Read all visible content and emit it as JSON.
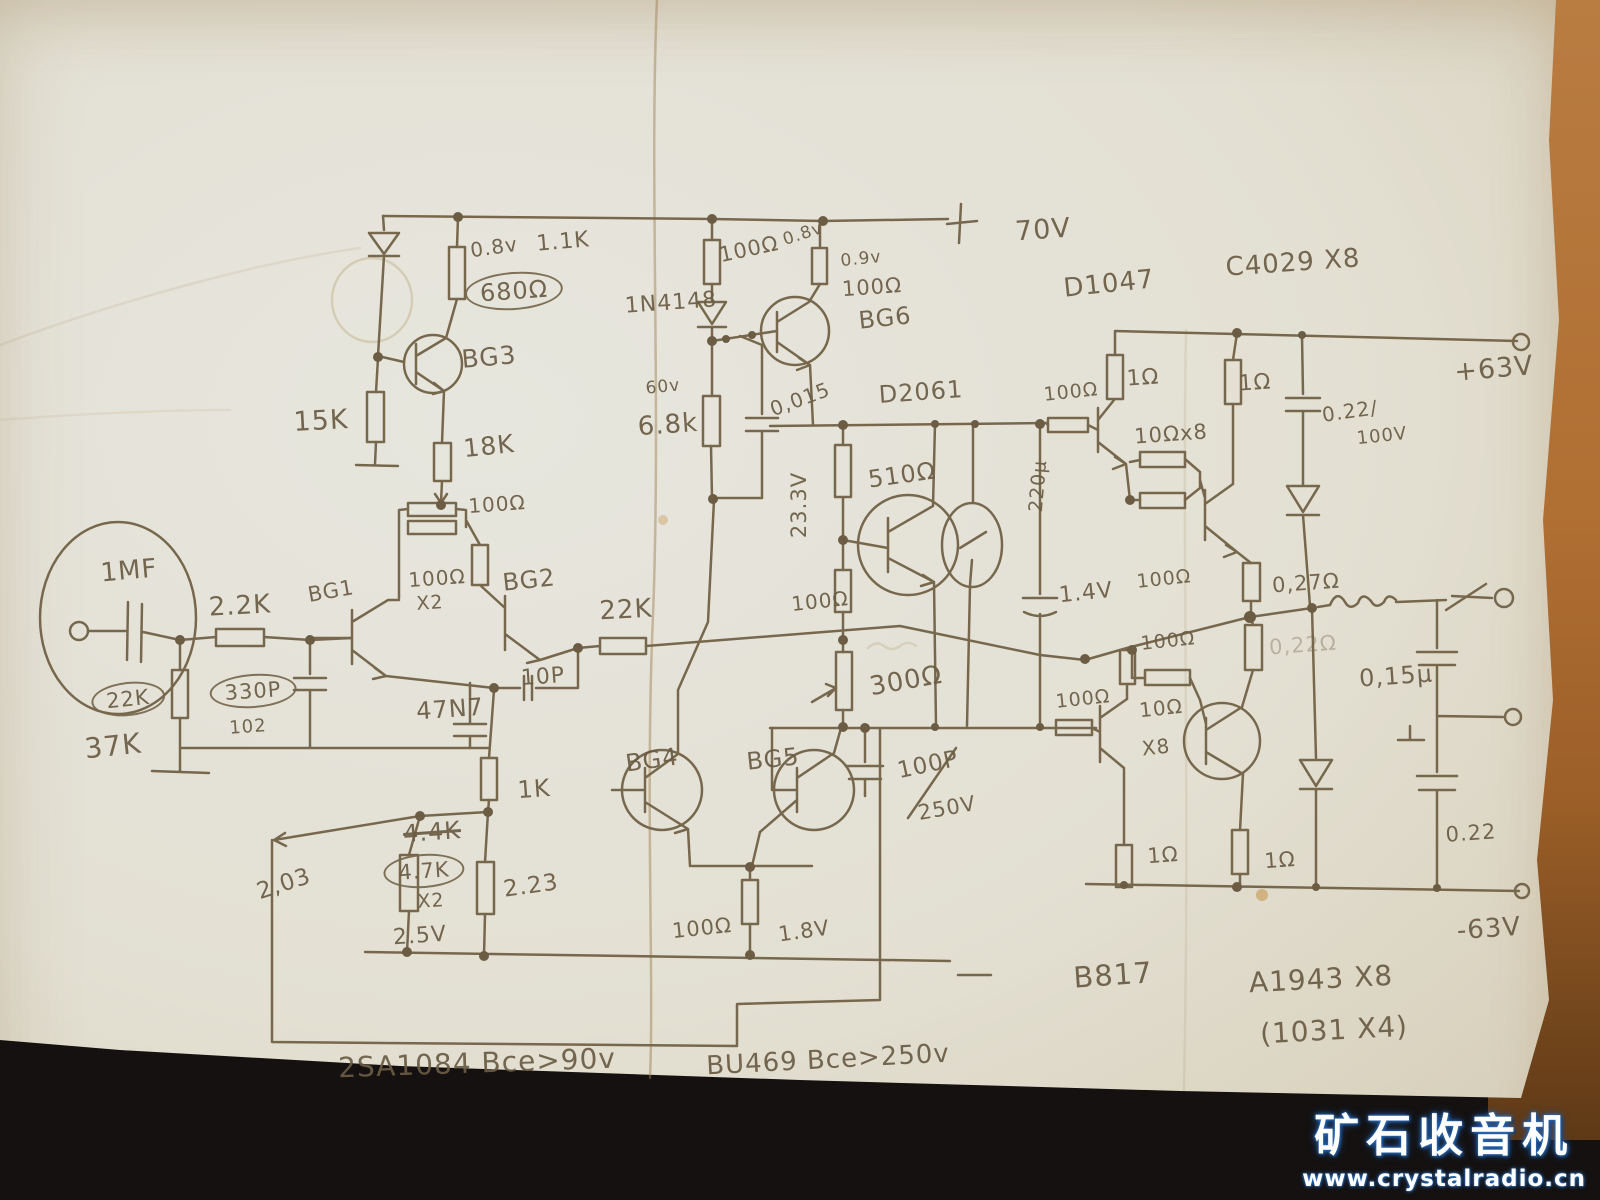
{
  "watermark": {
    "site_name": "矿石收音机",
    "site_url": "www.crystalradio.cn"
  },
  "schematic": {
    "labels": [
      {
        "t": "0.8v",
        "x": 494,
        "y": 247,
        "s": 20,
        "r": -8
      },
      {
        "t": "1.1K",
        "x": 563,
        "y": 242,
        "s": 22,
        "r": -5
      },
      {
        "t": "680Ω",
        "x": 514,
        "y": 291,
        "s": 24,
        "r": -4,
        "c": "circled"
      },
      {
        "t": "BG3",
        "x": 489,
        "y": 357,
        "s": 25,
        "r": -5
      },
      {
        "t": "15K",
        "x": 321,
        "y": 421,
        "s": 27,
        "r": -3
      },
      {
        "t": "18K",
        "x": 489,
        "y": 446,
        "s": 25,
        "r": -6
      },
      {
        "t": "1N4148",
        "x": 671,
        "y": 303,
        "s": 22,
        "r": -4
      },
      {
        "t": "100Ω",
        "x": 749,
        "y": 249,
        "s": 21,
        "r": -12
      },
      {
        "t": "0.8v",
        "x": 803,
        "y": 234,
        "s": 17,
        "r": -18
      },
      {
        "t": "0.9v",
        "x": 861,
        "y": 259,
        "s": 17,
        "r": -6
      },
      {
        "t": "100Ω",
        "x": 872,
        "y": 287,
        "s": 21,
        "r": -4
      },
      {
        "t": "BG6",
        "x": 885,
        "y": 318,
        "s": 24,
        "r": -6
      },
      {
        "t": "60v",
        "x": 663,
        "y": 387,
        "s": 17,
        "r": -6
      },
      {
        "t": "6.8k",
        "x": 668,
        "y": 425,
        "s": 26,
        "r": -4
      },
      {
        "t": "0,015",
        "x": 800,
        "y": 399,
        "s": 20,
        "r": -20
      },
      {
        "t": "D2061",
        "x": 921,
        "y": 392,
        "s": 24,
        "r": -4
      },
      {
        "t": "70V",
        "x": 1043,
        "y": 230,
        "s": 27,
        "r": -4
      },
      {
        "t": "D1047",
        "x": 1109,
        "y": 284,
        "s": 26,
        "r": -6
      },
      {
        "t": "C4029 X8",
        "x": 1293,
        "y": 263,
        "s": 26,
        "r": -4
      },
      {
        "t": "100Ω",
        "x": 1071,
        "y": 392,
        "s": 19,
        "r": -6
      },
      {
        "t": "1Ω",
        "x": 1143,
        "y": 378,
        "s": 22,
        "r": -4
      },
      {
        "t": "1Ω",
        "x": 1255,
        "y": 383,
        "s": 22,
        "r": -4
      },
      {
        "t": "10Ωx8",
        "x": 1171,
        "y": 434,
        "s": 21,
        "r": -4
      },
      {
        "t": "0.22/",
        "x": 1350,
        "y": 411,
        "s": 20,
        "r": -8
      },
      {
        "t": "100V",
        "x": 1382,
        "y": 436,
        "s": 18,
        "r": -6
      },
      {
        "t": "+63V",
        "x": 1494,
        "y": 369,
        "s": 27,
        "r": -5
      },
      {
        "t": "100Ω",
        "x": 497,
        "y": 504,
        "s": 20,
        "r": -4
      },
      {
        "t": "100Ω",
        "x": 437,
        "y": 578,
        "s": 20,
        "r": -4
      },
      {
        "t": "X2",
        "x": 430,
        "y": 603,
        "s": 19,
        "r": -4
      },
      {
        "t": "BG1",
        "x": 331,
        "y": 591,
        "s": 21,
        "r": -10
      },
      {
        "t": "BG2",
        "x": 529,
        "y": 580,
        "s": 24,
        "r": -6
      },
      {
        "t": "2.2K",
        "x": 240,
        "y": 606,
        "s": 26,
        "r": -3
      },
      {
        "t": "1MF",
        "x": 129,
        "y": 571,
        "s": 26,
        "r": -5
      },
      {
        "t": "22K",
        "x": 128,
        "y": 699,
        "s": 21,
        "r": -6,
        "c": "circled"
      },
      {
        "t": "37K",
        "x": 113,
        "y": 746,
        "s": 28,
        "r": -6
      },
      {
        "t": "330P",
        "x": 253,
        "y": 691,
        "s": 21,
        "r": -4,
        "c": "circled"
      },
      {
        "t": "102",
        "x": 248,
        "y": 727,
        "s": 18,
        "r": -4
      },
      {
        "t": "22K",
        "x": 626,
        "y": 610,
        "s": 26,
        "r": -3
      },
      {
        "t": "10P",
        "x": 543,
        "y": 677,
        "s": 22,
        "r": -4
      },
      {
        "t": "47N7",
        "x": 450,
        "y": 709,
        "s": 24,
        "r": -4
      },
      {
        "t": "1K",
        "x": 534,
        "y": 789,
        "s": 24,
        "r": -4
      },
      {
        "t": "510Ω",
        "x": 902,
        "y": 475,
        "s": 24,
        "r": -8
      },
      {
        "t": "23.3V",
        "x": 799,
        "y": 505,
        "s": 21,
        "r": -90
      },
      {
        "t": "100Ω",
        "x": 820,
        "y": 601,
        "s": 20,
        "r": -6
      },
      {
        "t": "300Ω",
        "x": 906,
        "y": 681,
        "s": 26,
        "r": -10
      },
      {
        "t": "220µ",
        "x": 1038,
        "y": 486,
        "s": 19,
        "r": -85
      },
      {
        "t": "1.4V",
        "x": 1086,
        "y": 593,
        "s": 22,
        "r": -6
      },
      {
        "t": "100Ω",
        "x": 1164,
        "y": 579,
        "s": 19,
        "r": -6
      },
      {
        "t": "100Ω",
        "x": 1168,
        "y": 641,
        "s": 19,
        "r": -6
      },
      {
        "t": "100Ω",
        "x": 1083,
        "y": 699,
        "s": 19,
        "r": -6
      },
      {
        "t": "10Ω",
        "x": 1161,
        "y": 708,
        "s": 20,
        "r": -6
      },
      {
        "t": "X8",
        "x": 1156,
        "y": 747,
        "s": 20,
        "r": -6
      },
      {
        "t": "0,27Ω",
        "x": 1306,
        "y": 583,
        "s": 21,
        "r": -4
      },
      {
        "t": "0,22Ω",
        "x": 1303,
        "y": 645,
        "s": 21,
        "r": -4,
        "c": "faint"
      },
      {
        "t": "0,15µ",
        "x": 1396,
        "y": 676,
        "s": 24,
        "r": -4
      },
      {
        "t": "0.22",
        "x": 1471,
        "y": 833,
        "s": 21,
        "r": -4
      },
      {
        "t": "100Ω",
        "x": 702,
        "y": 928,
        "s": 21,
        "r": -6
      },
      {
        "t": "1.8V",
        "x": 804,
        "y": 931,
        "s": 21,
        "r": -8
      },
      {
        "t": "100P",
        "x": 928,
        "y": 765,
        "s": 23,
        "r": -12
      },
      {
        "t": "250V",
        "x": 947,
        "y": 808,
        "s": 21,
        "r": -10
      },
      {
        "t": "BG4",
        "x": 652,
        "y": 760,
        "s": 24,
        "r": -8
      },
      {
        "t": "BG5",
        "x": 773,
        "y": 759,
        "s": 24,
        "r": -6
      },
      {
        "t": "4.4K",
        "x": 432,
        "y": 832,
        "s": 24,
        "r": -4,
        "c": "strike"
      },
      {
        "t": "4.7K",
        "x": 424,
        "y": 871,
        "s": 21,
        "r": -4,
        "c": "circled"
      },
      {
        "t": "X2",
        "x": 431,
        "y": 901,
        "s": 19,
        "r": -4
      },
      {
        "t": "2.5V",
        "x": 420,
        "y": 936,
        "s": 22,
        "r": -4
      },
      {
        "t": "2,03",
        "x": 284,
        "y": 884,
        "s": 23,
        "r": -18
      },
      {
        "t": "2.23",
        "x": 531,
        "y": 886,
        "s": 23,
        "r": -8
      },
      {
        "t": "2SA1084  Bce>90v",
        "x": 477,
        "y": 1063,
        "s": 28,
        "r": -2
      },
      {
        "t": "BU469  Bce>250v",
        "x": 828,
        "y": 1060,
        "s": 26,
        "r": -3
      },
      {
        "t": "B817",
        "x": 1113,
        "y": 975,
        "s": 29,
        "r": -4
      },
      {
        "t": "A1943 X8",
        "x": 1321,
        "y": 979,
        "s": 28,
        "r": -3
      },
      {
        "t": "(1031 X4)",
        "x": 1334,
        "y": 1030,
        "s": 28,
        "r": -3
      },
      {
        "t": "-63V",
        "x": 1489,
        "y": 929,
        "s": 26,
        "r": -4
      },
      {
        "t": "1Ω",
        "x": 1163,
        "y": 855,
        "s": 21,
        "r": -4
      },
      {
        "t": "1Ω",
        "x": 1280,
        "y": 860,
        "s": 21,
        "r": -4
      }
    ]
  }
}
